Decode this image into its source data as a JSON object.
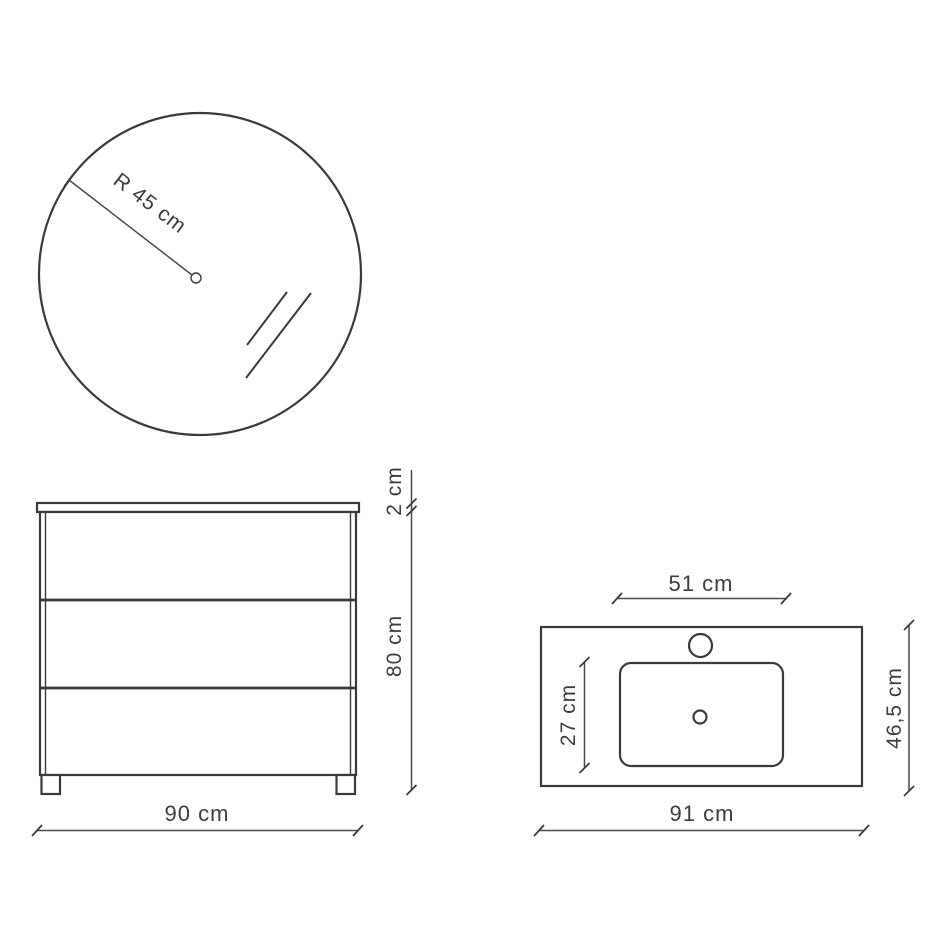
{
  "page": {
    "background": "#ffffff",
    "line_color": "#3a3a3a",
    "text_color": "#3d3d3d"
  },
  "mirror": {
    "radius_label": "R 45 cm"
  },
  "cabinet": {
    "top_thickness_label": "2 cm",
    "height_label": "80 cm",
    "width_label": "90 cm"
  },
  "washbasin": {
    "basin_width_label": "51 cm",
    "basin_depth_label": "27 cm",
    "depth_label": "46,5 cm",
    "width_label": "91 cm"
  }
}
